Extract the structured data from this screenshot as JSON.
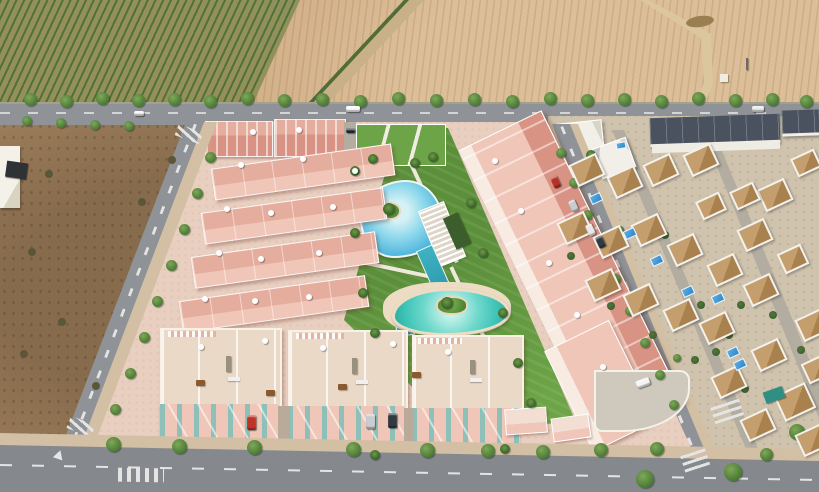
{
  "meta": {
    "kind": "aerial-architectural-render",
    "description": "Bird's-eye render of a new pink residential development with lagoon-style communal pools, bordered by an orchard and a plowed field to the north, a vacant dirt lot to the west, and an existing white-villa neighborhood with terracotta roofs and private pools to the east.",
    "width": 819,
    "height": 492
  },
  "colors": {
    "base_tan": "#c9a77c",
    "orchard_green": "#87945a",
    "orchard_row": "#51713a",
    "orchard_soil": "#c8b088",
    "field_tan": "#c9a379",
    "road_grey": "#8f9397",
    "road_dark": "#85898d",
    "dash_white": "#e4e4e4",
    "lot_brown": "#a3845f",
    "sidewalk_sand": "#d3bfa4",
    "pink_ground": "#e9cfc0",
    "pink_wall": "#f0c6b8",
    "pink_roof": "#e5ad9d",
    "pink_deep": "#d89384",
    "terrace_beige": "#ead9c7",
    "facade_teal": "#8fd0cb",
    "lawn_green": "#6da447",
    "lagoon_blue": "#4fb5dc",
    "lagoon_light": "#d6f1f5",
    "kids_teal": "#3fc4b7",
    "lap_teal": "#2f9cb0",
    "deck_cream": "#ecdcc4",
    "villa_base": "#cfc3ad",
    "villa_wall": "#f4f1ea",
    "villa_roof": "#c49e6c",
    "villa_roof_dark": "#a8814f",
    "navy_roof": "#49525e",
    "pool_blue": "#2e86c8",
    "tree_green": "#4a7a33",
    "palm_green": "#2f5a24",
    "bush_green": "#3c5e2d",
    "street_light": "#b3aca0"
  },
  "scene": {
    "regions": {
      "orchard": "Green orchard with diagonal tree rows, top left",
      "plowed_field": "Tan plowed field with dirt track, small hut and utility pole, top right",
      "main_road": "Tree-lined road running across the top with white car, van and truck",
      "vacant_lot": "Brown scrub lot with small white outbuilding and dark billboard, left",
      "development": "New pink apartment complex: top row blocks, four terraced rows, long main building, rooftop-solarium townhouses, communal gardens with lagoon pool, lap pool and children's pool",
      "villa_district": "Existing neighborhood of white villas with terracotta roofs, navy flat-roof townhouse rows, private blue pools, right side",
      "streets": "Left street, right street and bottom road with zebra crosswalks, lane dashes and a yield marking"
    },
    "sprites": [
      {
        "t": "tree",
        "x": 24,
        "y": 93
      },
      {
        "t": "tree",
        "x": 60,
        "y": 95
      },
      {
        "t": "tree",
        "x": 96,
        "y": 92
      },
      {
        "t": "tree",
        "x": 132,
        "y": 94
      },
      {
        "t": "tree",
        "x": 168,
        "y": 93
      },
      {
        "t": "tree",
        "x": 204,
        "y": 95
      },
      {
        "t": "tree",
        "x": 241,
        "y": 92
      },
      {
        "t": "tree",
        "x": 278,
        "y": 94
      },
      {
        "t": "tree",
        "x": 316,
        "y": 93
      },
      {
        "t": "tree",
        "x": 354,
        "y": 95
      },
      {
        "t": "tree",
        "x": 392,
        "y": 92
      },
      {
        "t": "tree",
        "x": 430,
        "y": 94
      },
      {
        "t": "tree",
        "x": 468,
        "y": 93
      },
      {
        "t": "tree",
        "x": 506,
        "y": 95
      },
      {
        "t": "tree",
        "x": 544,
        "y": 92
      },
      {
        "t": "tree",
        "x": 581,
        "y": 94
      },
      {
        "t": "tree",
        "x": 618,
        "y": 93
      },
      {
        "t": "tree",
        "x": 655,
        "y": 95
      },
      {
        "t": "tree",
        "x": 692,
        "y": 92
      },
      {
        "t": "tree",
        "x": 729,
        "y": 94
      },
      {
        "t": "tree",
        "x": 766,
        "y": 93
      },
      {
        "t": "tree",
        "x": 800,
        "y": 95
      },
      {
        "t": "tree",
        "x": 22,
        "y": 116,
        "w": 10,
        "h": 10
      },
      {
        "t": "tree",
        "x": 56,
        "y": 118,
        "w": 10,
        "h": 10
      },
      {
        "t": "tree",
        "x": 90,
        "y": 120,
        "w": 10,
        "h": 10
      },
      {
        "t": "tree",
        "x": 124,
        "y": 121,
        "w": 10,
        "h": 10
      },
      {
        "t": "tree",
        "x": 205,
        "y": 152,
        "w": 11,
        "h": 11
      },
      {
        "t": "tree",
        "x": 192,
        "y": 188,
        "w": 11,
        "h": 11
      },
      {
        "t": "tree",
        "x": 179,
        "y": 224,
        "w": 11,
        "h": 11
      },
      {
        "t": "tree",
        "x": 166,
        "y": 260,
        "w": 11,
        "h": 11
      },
      {
        "t": "tree",
        "x": 152,
        "y": 296,
        "w": 11,
        "h": 11
      },
      {
        "t": "tree",
        "x": 139,
        "y": 332,
        "w": 11,
        "h": 11
      },
      {
        "t": "tree",
        "x": 125,
        "y": 368,
        "w": 11,
        "h": 11
      },
      {
        "t": "tree",
        "x": 110,
        "y": 404,
        "w": 11,
        "h": 11
      },
      {
        "t": "tree",
        "x": 106,
        "y": 437,
        "w": 15,
        "h": 15
      },
      {
        "t": "tree",
        "x": 172,
        "y": 439,
        "w": 15,
        "h": 15
      },
      {
        "t": "tree",
        "x": 247,
        "y": 440,
        "w": 15,
        "h": 15
      },
      {
        "t": "tree",
        "x": 346,
        "y": 442,
        "w": 15,
        "h": 15
      },
      {
        "t": "tree",
        "x": 420,
        "y": 443,
        "w": 15,
        "h": 15
      },
      {
        "t": "tree",
        "x": 481,
        "y": 444,
        "w": 14,
        "h": 14
      },
      {
        "t": "tree",
        "x": 536,
        "y": 445,
        "w": 14,
        "h": 14
      },
      {
        "t": "tree",
        "x": 594,
        "y": 443,
        "w": 14,
        "h": 14
      },
      {
        "t": "tree",
        "x": 650,
        "y": 442,
        "w": 14,
        "h": 14
      },
      {
        "t": "tree",
        "x": 556,
        "y": 148,
        "w": 10,
        "h": 10
      },
      {
        "t": "tree",
        "x": 569,
        "y": 178,
        "w": 10,
        "h": 10
      },
      {
        "t": "tree",
        "x": 583,
        "y": 210,
        "w": 10,
        "h": 10
      },
      {
        "t": "tree",
        "x": 597,
        "y": 242,
        "w": 10,
        "h": 10
      },
      {
        "t": "tree",
        "x": 611,
        "y": 274,
        "w": 10,
        "h": 10
      },
      {
        "t": "tree",
        "x": 625,
        "y": 306,
        "w": 10,
        "h": 10
      },
      {
        "t": "tree",
        "x": 640,
        "y": 338,
        "w": 10,
        "h": 10
      },
      {
        "t": "tree",
        "x": 655,
        "y": 370,
        "w": 10,
        "h": 10
      },
      {
        "t": "tree",
        "x": 669,
        "y": 400,
        "w": 10,
        "h": 10
      },
      {
        "t": "tree",
        "x": 588,
        "y": 162,
        "w": 8,
        "h": 8
      },
      {
        "t": "tree",
        "x": 616,
        "y": 226,
        "w": 8,
        "h": 8
      },
      {
        "t": "tree",
        "x": 644,
        "y": 290,
        "w": 8,
        "h": 8
      },
      {
        "t": "tree",
        "x": 673,
        "y": 354,
        "w": 8,
        "h": 8
      },
      {
        "t": "tree",
        "x": 724,
        "y": 463,
        "w": 18,
        "h": 18
      },
      {
        "t": "tree",
        "x": 789,
        "y": 424,
        "w": 16,
        "h": 16
      },
      {
        "t": "tree",
        "x": 636,
        "y": 470,
        "w": 18,
        "h": 18
      },
      {
        "t": "tree",
        "x": 760,
        "y": 448,
        "w": 13,
        "h": 13
      },
      {
        "t": "bush",
        "x": 567,
        "y": 252
      },
      {
        "t": "bush",
        "x": 607,
        "y": 302
      },
      {
        "t": "bush",
        "x": 649,
        "y": 331
      },
      {
        "t": "bush",
        "x": 691,
        "y": 356
      },
      {
        "t": "bush",
        "x": 725,
        "y": 331
      },
      {
        "t": "bush",
        "x": 697,
        "y": 301
      },
      {
        "t": "bush",
        "x": 661,
        "y": 231
      },
      {
        "t": "bush",
        "x": 737,
        "y": 301
      },
      {
        "t": "bush",
        "x": 769,
        "y": 311
      },
      {
        "t": "bush",
        "x": 797,
        "y": 346
      },
      {
        "t": "bush",
        "x": 741,
        "y": 385
      },
      {
        "t": "bush",
        "x": 712,
        "y": 348
      },
      {
        "t": "bush",
        "x": 28,
        "y": 248,
        "c": "#5c5638"
      },
      {
        "t": "bush",
        "x": 58,
        "y": 318,
        "c": "#5c5638"
      },
      {
        "t": "bush",
        "x": 92,
        "y": 382,
        "c": "#5c5638"
      },
      {
        "t": "bush",
        "x": 138,
        "y": 198,
        "c": "#5c5638"
      },
      {
        "t": "bush",
        "x": 168,
        "y": 156,
        "c": "#5c5638"
      },
      {
        "t": "bush",
        "x": 45,
        "y": 170,
        "c": "#5c5638"
      },
      {
        "t": "bush",
        "x": 20,
        "y": 350,
        "c": "#5c5638"
      },
      {
        "t": "palm",
        "x": 350,
        "y": 166
      },
      {
        "t": "palm",
        "x": 368,
        "y": 154
      },
      {
        "t": "palm",
        "x": 410,
        "y": 158
      },
      {
        "t": "palm",
        "x": 428,
        "y": 152
      },
      {
        "t": "palm",
        "x": 350,
        "y": 228
      },
      {
        "t": "palm",
        "x": 358,
        "y": 288
      },
      {
        "t": "palm",
        "x": 370,
        "y": 328
      },
      {
        "t": "palm",
        "x": 466,
        "y": 198
      },
      {
        "t": "palm",
        "x": 478,
        "y": 248
      },
      {
        "t": "palm",
        "x": 498,
        "y": 308
      },
      {
        "t": "palm",
        "x": 513,
        "y": 358
      },
      {
        "t": "palm",
        "x": 526,
        "y": 398
      },
      {
        "t": "palm",
        "x": 383,
        "y": 203,
        "w": 12,
        "h": 12
      },
      {
        "t": "palm",
        "x": 441,
        "y": 297,
        "w": 12,
        "h": 12
      },
      {
        "t": "palm",
        "x": 370,
        "y": 450
      },
      {
        "t": "palm",
        "x": 500,
        "y": 444
      },
      {
        "t": "palm",
        "x": 586,
        "y": 150
      },
      {
        "t": "parasol",
        "x": 238,
        "y": 162
      },
      {
        "t": "parasol",
        "x": 300,
        "y": 156
      },
      {
        "t": "parasol",
        "x": 352,
        "y": 168
      },
      {
        "t": "parasol",
        "x": 224,
        "y": 206
      },
      {
        "t": "parasol",
        "x": 268,
        "y": 210
      },
      {
        "t": "parasol",
        "x": 330,
        "y": 204
      },
      {
        "t": "parasol",
        "x": 216,
        "y": 250
      },
      {
        "t": "parasol",
        "x": 258,
        "y": 256
      },
      {
        "t": "parasol",
        "x": 316,
        "y": 250
      },
      {
        "t": "parasol",
        "x": 202,
        "y": 296
      },
      {
        "t": "parasol",
        "x": 252,
        "y": 298
      },
      {
        "t": "parasol",
        "x": 306,
        "y": 294
      },
      {
        "t": "parasol",
        "x": 250,
        "y": 129
      },
      {
        "t": "parasol",
        "x": 296,
        "y": 127
      },
      {
        "t": "parasol",
        "x": 492,
        "y": 158
      },
      {
        "t": "parasol",
        "x": 518,
        "y": 208
      },
      {
        "t": "parasol",
        "x": 546,
        "y": 260
      },
      {
        "t": "parasol",
        "x": 574,
        "y": 312
      },
      {
        "t": "parasol",
        "x": 600,
        "y": 364
      },
      {
        "t": "parasol",
        "x": 198,
        "y": 344
      },
      {
        "t": "parasol",
        "x": 262,
        "y": 338
      },
      {
        "t": "parasol",
        "x": 320,
        "y": 345
      },
      {
        "t": "parasol",
        "x": 390,
        "y": 341
      },
      {
        "t": "parasol",
        "x": 445,
        "y": 349
      },
      {
        "t": "table",
        "x": 196,
        "y": 380
      },
      {
        "t": "table",
        "x": 266,
        "y": 390
      },
      {
        "t": "table",
        "x": 338,
        "y": 384
      },
      {
        "t": "table",
        "x": 412,
        "y": 372
      },
      {
        "t": "bench",
        "x": 228,
        "y": 377
      },
      {
        "t": "bench",
        "x": 356,
        "y": 380
      },
      {
        "t": "bench",
        "x": 470,
        "y": 378
      },
      {
        "t": "villa",
        "x": 572,
        "y": 158,
        "r": -25
      },
      {
        "t": "villa",
        "x": 610,
        "y": 170,
        "r": -25
      },
      {
        "t": "villa",
        "x": 646,
        "y": 158,
        "r": -25
      },
      {
        "t": "villa",
        "x": 686,
        "y": 148,
        "r": -25
      },
      {
        "t": "villa",
        "x": 560,
        "y": 216,
        "r": -25
      },
      {
        "t": "villa",
        "x": 596,
        "y": 230,
        "r": -25
      },
      {
        "t": "villa",
        "x": 634,
        "y": 218,
        "r": -25
      },
      {
        "t": "villa",
        "x": 670,
        "y": 238,
        "r": -25
      },
      {
        "t": "villa",
        "x": 588,
        "y": 273,
        "r": -25
      },
      {
        "t": "villa",
        "x": 626,
        "y": 288,
        "r": -25
      },
      {
        "t": "villa",
        "x": 666,
        "y": 303,
        "r": -25
      },
      {
        "t": "villa",
        "x": 702,
        "y": 316,
        "r": -25
      },
      {
        "t": "villa",
        "x": 710,
        "y": 258,
        "r": -25
      },
      {
        "t": "villa",
        "x": 740,
        "y": 223,
        "r": -25
      },
      {
        "t": "villa",
        "x": 760,
        "y": 183,
        "r": -25
      },
      {
        "t": "villa",
        "x": 793,
        "y": 153,
        "r": -25,
        "w": 22,
        "h": 16
      },
      {
        "t": "villa",
        "x": 746,
        "y": 278,
        "r": -25
      },
      {
        "t": "villa",
        "x": 780,
        "y": 248,
        "r": -25,
        "w": 22,
        "h": 18
      },
      {
        "t": "villa",
        "x": 798,
        "y": 313,
        "r": -25
      },
      {
        "t": "villa",
        "x": 754,
        "y": 343,
        "r": -25
      },
      {
        "t": "villa",
        "x": 714,
        "y": 370,
        "r": -25
      },
      {
        "t": "villa",
        "x": 778,
        "y": 388,
        "r": -25,
        "w": 30,
        "h": 24
      },
      {
        "t": "villa",
        "x": 804,
        "y": 358,
        "r": -25,
        "w": 22,
        "h": 18
      },
      {
        "t": "villa",
        "x": 743,
        "y": 413,
        "r": -25
      },
      {
        "t": "villa",
        "x": 798,
        "y": 428,
        "r": -25
      },
      {
        "t": "villa",
        "x": 732,
        "y": 186,
        "r": -25,
        "w": 22,
        "h": 16
      },
      {
        "t": "villa",
        "x": 698,
        "y": 196,
        "r": -25,
        "w": 22,
        "h": 16
      },
      {
        "t": "pool",
        "x": 590,
        "y": 194,
        "r": -25
      },
      {
        "t": "pool",
        "x": 624,
        "y": 229,
        "r": -25
      },
      {
        "t": "pool",
        "x": 651,
        "y": 256,
        "r": -25
      },
      {
        "t": "pool",
        "x": 682,
        "y": 287,
        "r": -25
      },
      {
        "t": "pool",
        "x": 712,
        "y": 294,
        "r": -25
      },
      {
        "t": "pool",
        "x": 727,
        "y": 348,
        "r": -25
      },
      {
        "t": "pool",
        "x": 734,
        "y": 360,
        "r": -25
      },
      {
        "t": "pool",
        "x": 616,
        "y": 142,
        "r": -10,
        "w": 8,
        "h": 5
      },
      {
        "t": "block",
        "x": 764,
        "y": 389,
        "w": 20,
        "h": 12,
        "r": -20,
        "c": "#2e8f82"
      },
      {
        "t": "block",
        "x": 720,
        "y": 74,
        "w": 8,
        "h": 8,
        "c": "#f0ece2"
      },
      {
        "t": "block",
        "x": 746,
        "y": 58,
        "w": 2,
        "h": 12,
        "c": "#6a6a6a"
      },
      {
        "t": "blob",
        "x": 686,
        "y": 16,
        "w": 28,
        "h": 11,
        "r": -8,
        "c": "#9a7f52"
      },
      {
        "t": "block",
        "x": 226,
        "y": 356,
        "w": 5,
        "h": 16,
        "c": "#99907f"
      },
      {
        "t": "block",
        "x": 352,
        "y": 358,
        "w": 5,
        "h": 16,
        "c": "#99907f"
      },
      {
        "t": "block",
        "x": 470,
        "y": 360,
        "w": 5,
        "h": 14,
        "c": "#99907f"
      },
      {
        "t": "car",
        "x": 134,
        "y": 111,
        "w": 10,
        "h": 5,
        "c": "#f2f2f2"
      },
      {
        "t": "car",
        "x": 346,
        "y": 106,
        "w": 14,
        "h": 6,
        "c": "#fafafa"
      },
      {
        "t": "car",
        "x": 752,
        "y": 106,
        "w": 12,
        "h": 6,
        "c": "#e8e8e8"
      },
      {
        "t": "car",
        "x": 346,
        "y": 128,
        "w": 9,
        "h": 5,
        "c": "#2f343a"
      },
      {
        "t": "car",
        "x": 247,
        "y": 415,
        "w": 9,
        "h": 15,
        "c": "#c03428"
      },
      {
        "t": "car",
        "x": 366,
        "y": 414,
        "w": 9,
        "h": 15,
        "c": "#c9ccd0"
      },
      {
        "t": "car",
        "x": 388,
        "y": 413,
        "w": 9,
        "h": 15,
        "c": "#343a42"
      },
      {
        "t": "car",
        "x": 636,
        "y": 379,
        "w": 14,
        "h": 8,
        "r": -20,
        "c": "#f5f5f5"
      },
      {
        "t": "car",
        "x": 552,
        "y": 176,
        "w": 7,
        "h": 12,
        "r": -25,
        "c": "#b92f22"
      },
      {
        "t": "car",
        "x": 570,
        "y": 200,
        "w": 7,
        "h": 12,
        "r": -25,
        "c": "#c9ccd0"
      },
      {
        "t": "car",
        "x": 587,
        "y": 224,
        "w": 7,
        "h": 12,
        "r": -25,
        "c": "#e8e8e8"
      },
      {
        "t": "car",
        "x": 597,
        "y": 236,
        "w": 7,
        "h": 12,
        "r": -25,
        "c": "#343a42"
      }
    ]
  }
}
